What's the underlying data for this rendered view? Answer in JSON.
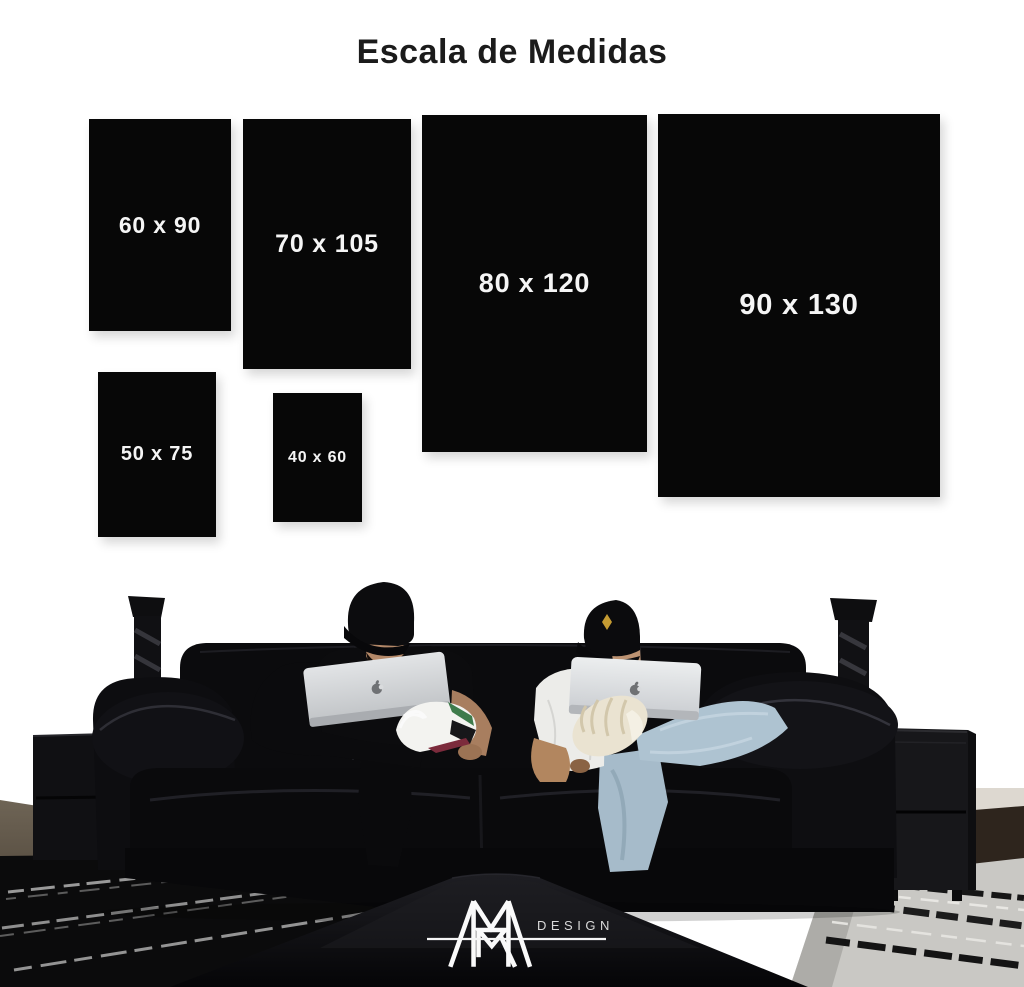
{
  "title": "Escala de Medidas",
  "sizes": [
    {
      "id": "60x90",
      "label": "60 x 90"
    },
    {
      "id": "70x105",
      "label": "70 x 105"
    },
    {
      "id": "80x120",
      "label": "80 x 120"
    },
    {
      "id": "90x130",
      "label": "90 x 130"
    },
    {
      "id": "50x75",
      "label": "50 x 75"
    },
    {
      "id": "40x60",
      "label": "40 x 60"
    }
  ],
  "brand": {
    "design_label": "DESIGN",
    "monogram_icon": "mr-monogram-icon"
  },
  "icons": {
    "laptop_logo": "apple-logo-icon",
    "left_decor": "twisted-candlestick-icon",
    "right_decor": "twisted-candlestick-icon"
  },
  "colors": {
    "background": "#ffffff",
    "title_text": "#1b1b1b",
    "swatch_bg": "#070707",
    "swatch_text": "#f5f5f5",
    "logo_white": "#fafafa"
  }
}
